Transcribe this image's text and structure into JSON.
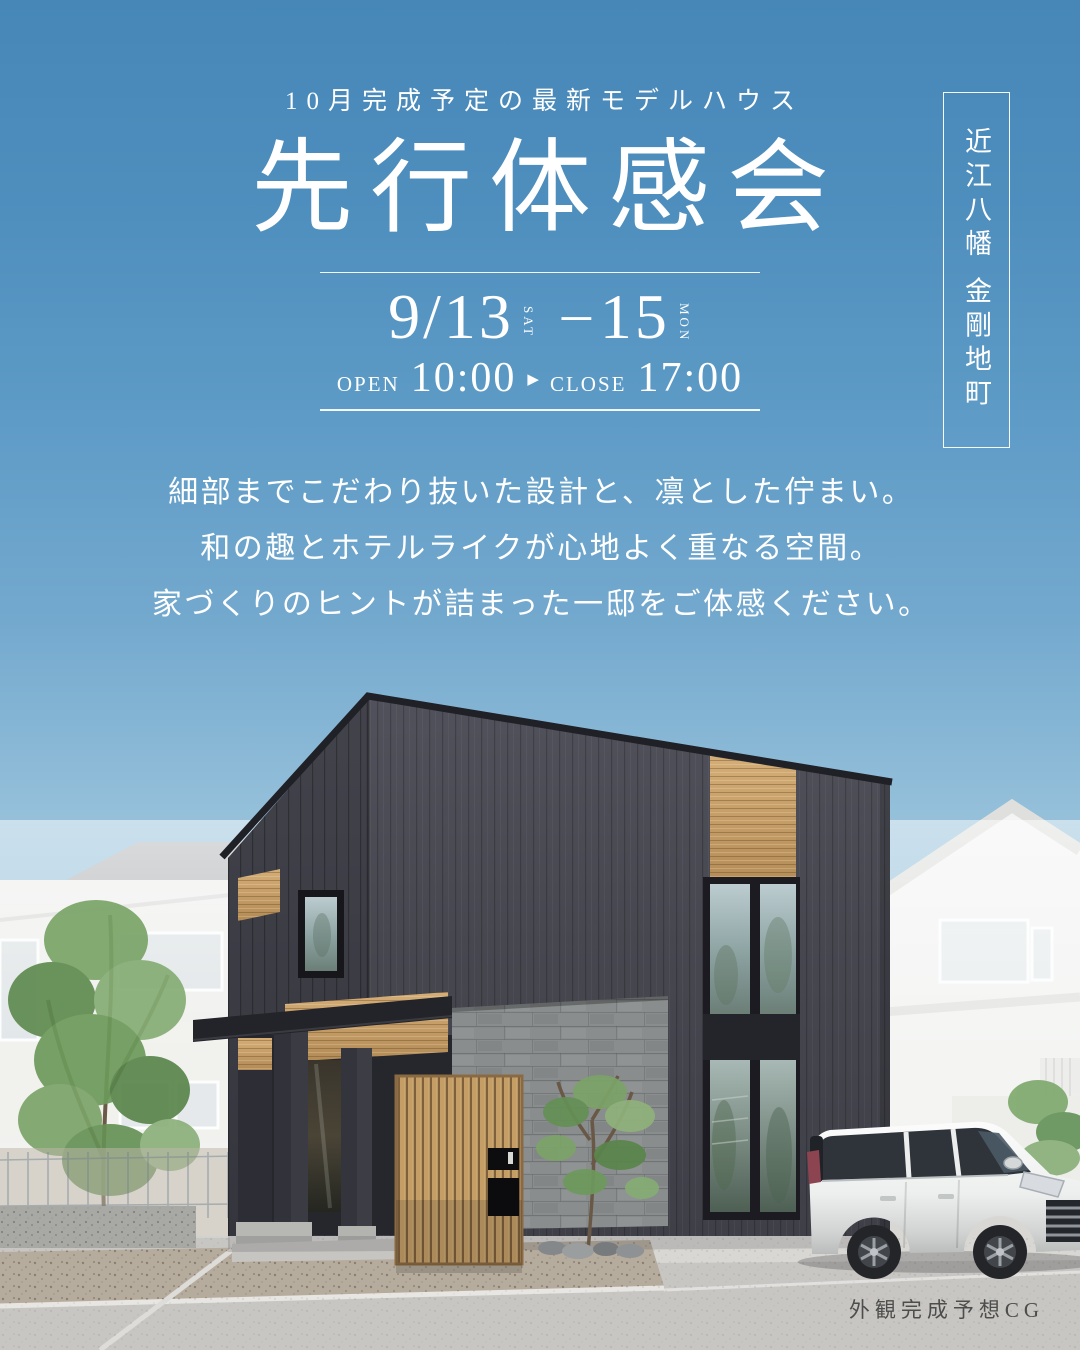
{
  "poster": {
    "eyebrow": "10月完成予定の最新モデルハウス",
    "title": "先行体感会",
    "schedule": {
      "start_date": "9/13",
      "start_dow": "SAT",
      "separator": "–",
      "end_date": "15",
      "end_dow": "MON"
    },
    "hours": {
      "open_label": "OPEN",
      "open_time": "10:00",
      "arrow_icon": "▶",
      "close_label": "CLOSE",
      "close_time": "17:00"
    },
    "location": "近江八幡 金剛地町",
    "body_lines": [
      "細部までこだわり抜いた設計と、凛とした佇まい。",
      "和の趣とホテルライクが心地よく重なる空間。",
      "家づくりのヒントが詰まった一邸をご体感ください。"
    ],
    "cg_caption": "外観完成予想CG"
  },
  "colors": {
    "sky_top": "#4687b8",
    "sky_horizon": "#e2eff2",
    "text": "#ffffff",
    "house_wall": "#4a4a53",
    "house_wall_shade": "#3c3c45",
    "wood_accent": "#c8a066",
    "stone_tile": "#898d8d",
    "road": "#c8c6c3",
    "caption_text": "#4d4d4b"
  }
}
